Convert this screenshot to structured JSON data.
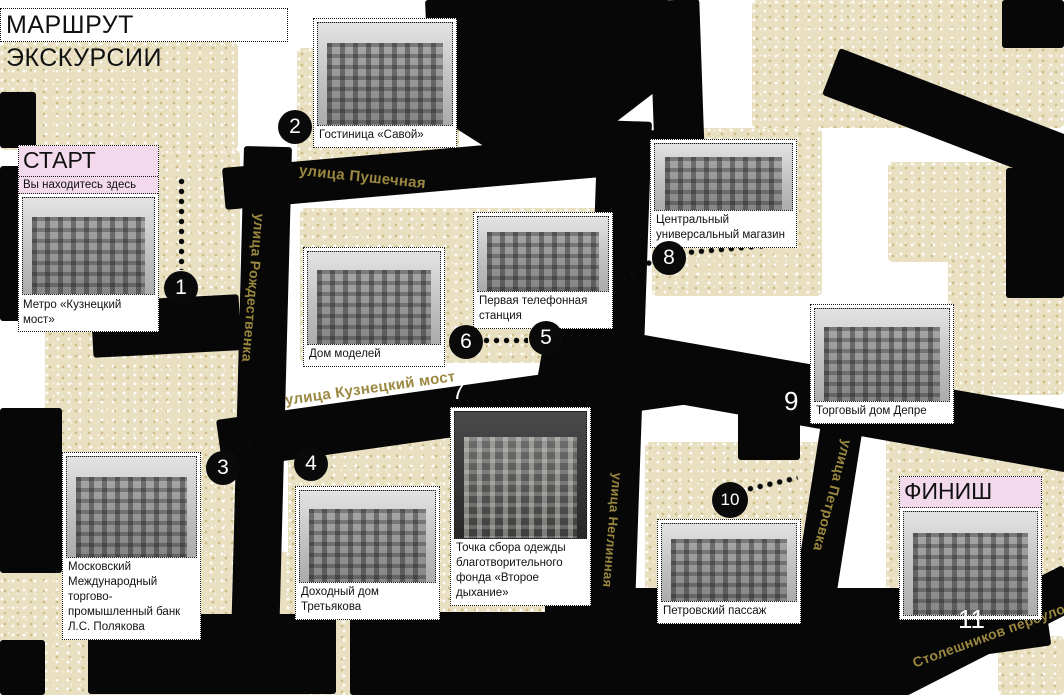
{
  "title": "МАРШРУТ ЭКСКУРСИИ",
  "start": {
    "label": "СТАРТ",
    "sublabel": "Вы находитесь здесь",
    "number": "1",
    "caption": "Метро «Кузнецкий мост»"
  },
  "finish": {
    "label": "ФИНИШ",
    "number": "11"
  },
  "stops": {
    "2": {
      "number": "2",
      "caption": "Гостиница «Савой»"
    },
    "3": {
      "number": "3",
      "caption": "Московский Международный торгово-промышленный банк Л.С. Полякова"
    },
    "4": {
      "number": "4",
      "caption": "Доходный дом Третьякова"
    },
    "5": {
      "number": "5",
      "caption": "Первая телефонная станция"
    },
    "6": {
      "number": "6",
      "caption": "Дом моделей"
    },
    "7": {
      "number": "7",
      "caption": "Точка сбора одежды благотворительного фонда «Второе дыхание»"
    },
    "8": {
      "number": "8",
      "caption": "Центральный универсальный магазин"
    },
    "9": {
      "number": "9",
      "caption": "Торговый дом Депре"
    },
    "10": {
      "number": "10",
      "caption": "Петровский пассаж"
    }
  },
  "streets": {
    "pushechnaya": "улица Пушечная",
    "rozhdestvenka": "улица Рождественка",
    "kuznetsky": "улица Кузнецкий мост",
    "neglinnaya": "улица Неглинная",
    "petrovka": "улица Петровка",
    "stoleshnikov": "Столешников переулок"
  },
  "colors": {
    "highlight_pink": "#f3d9ec",
    "street_label_gold": "#9a8840",
    "block_beige": "#e9e0c2",
    "street_black": "#070707"
  }
}
